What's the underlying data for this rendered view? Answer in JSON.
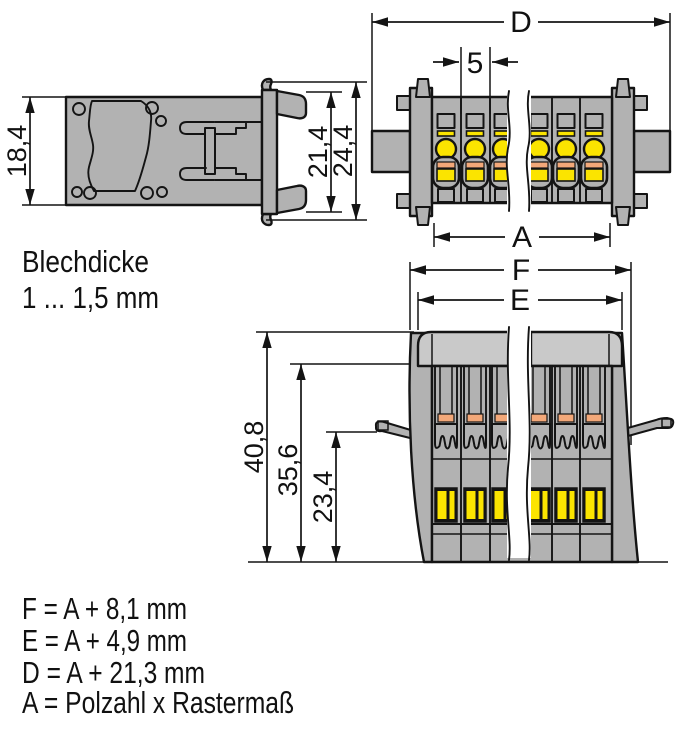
{
  "drawing": {
    "material_note": {
      "line1": "Blechdicke",
      "line2": "1 ... 1,5 mm"
    },
    "formulas": [
      "F = A + 8,1 mm",
      "E = A + 4,9 mm",
      "D = A + 21,3 mm",
      "A = Polzahl x Rastermaß"
    ],
    "dimensions": {
      "side_view": {
        "plate_height": "18,4",
        "flange_inner_height": "21,4",
        "flange_outer_height": "24,4"
      },
      "top_view": {
        "overall_width": "D",
        "pole_pitch": "5",
        "poles_width": "A"
      },
      "profile_view": {
        "overall_width_f": "F",
        "housing_width_e": "E",
        "overall_height": "40,8",
        "height_below_cover": "35,6",
        "height_at_lever": "23,4"
      }
    },
    "colors": {
      "housing": "#b2b2b2",
      "cover": "#c9c9c9",
      "accent_yellow": "#fbe400",
      "accent_orange": "#f3a879",
      "line": "#141414",
      "background": "#ffffff"
    }
  }
}
